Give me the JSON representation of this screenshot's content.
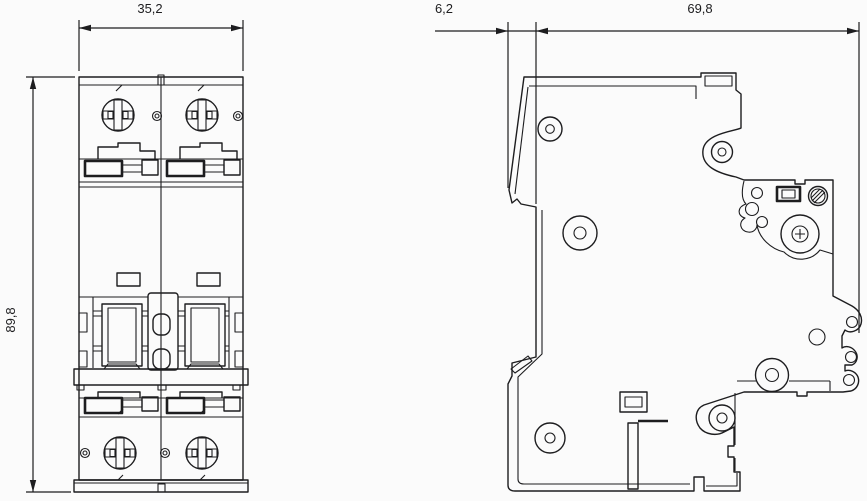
{
  "drawing": {
    "front_view": {
      "width_dim": "35,2",
      "height_dim": "89,8"
    },
    "side_view": {
      "offset_dim": "6,2",
      "depth_dim": "69,8"
    }
  },
  "colors": {
    "line": "#1d1d1f",
    "background": "#fbfbfb"
  }
}
